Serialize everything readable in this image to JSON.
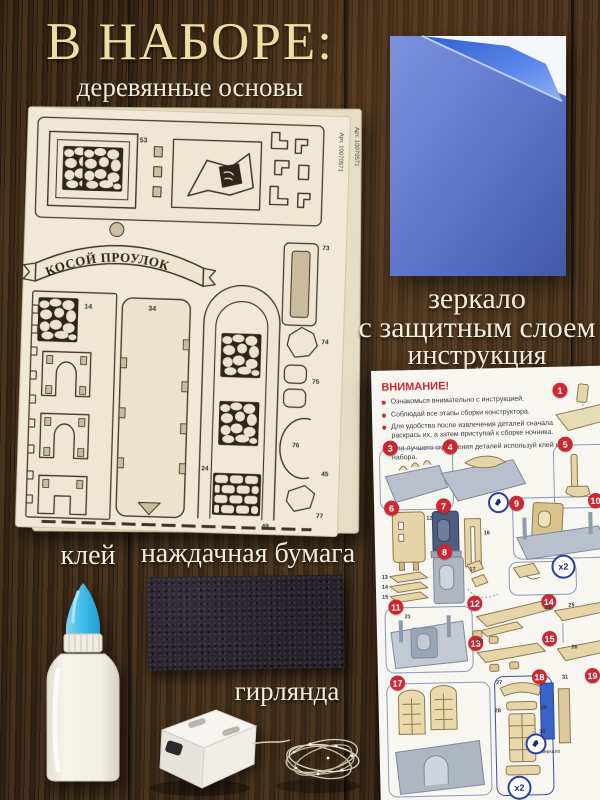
{
  "page": {
    "title": "В НАБОРЕ:",
    "subtitle": "деревянные основы"
  },
  "items": {
    "mirror": {
      "label_line1": "зеркало",
      "label_line2": "с защитным слоем"
    },
    "instruction": {
      "label": "инструкция"
    },
    "glue": {
      "label": "клей"
    },
    "sandpaper": {
      "label": "наждачная бумага"
    },
    "garland": {
      "label": "гирлянда"
    }
  },
  "wood_sheet": {
    "banner_text": "КОСОЙ ПРОУЛОК",
    "article_text": "Арт. 10070571",
    "part_numbers": [
      "53",
      "34",
      "14",
      "24",
      "49",
      "73",
      "74",
      "75",
      "76",
      "77",
      "45"
    ]
  },
  "instruction_sheet": {
    "warning_title": "ВНИМАНИЕ!",
    "bullets": [
      "Ознакомься внимательно с инструкцией.",
      "Соблюдай все этапы сборки конструктора.",
      "Для удобства после извлечения деталей сначала раскрась их, а затем приступай к сборке ночника.",
      "Для лучшего скрепления деталей используй клей из набора."
    ],
    "steps_visible": [
      "1",
      "3",
      "4",
      "5",
      "6",
      "7",
      "8",
      "9",
      "10",
      "11",
      "12",
      "13",
      "14",
      "15",
      "17",
      "18",
      "19"
    ],
    "x2_label": "x2",
    "mirror_note": "зеркало",
    "part_callouts": [
      "12",
      "13",
      "14",
      "15",
      "16",
      "17",
      "21",
      "23",
      "24",
      "25",
      "26",
      "27",
      "28",
      "29",
      "30",
      "31"
    ]
  },
  "colors": {
    "title_gold": "#ecdfa2",
    "label_cream": "#f3ecd9",
    "mirror_blue": "#5d74c9",
    "warning_red": "#cc2830",
    "sheet_beige": "#f1e9d7",
    "glue_cap_blue": "#3fbbe8",
    "sandpaper_black": "#26222a",
    "instruction_accent_blue": "#2b3f9e"
  }
}
